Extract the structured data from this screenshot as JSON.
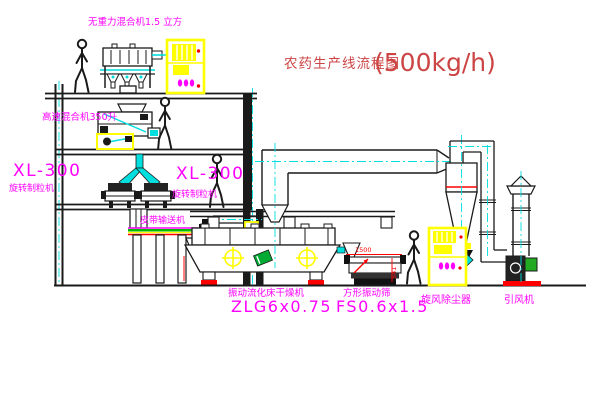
{
  "title": {
    "name": "农药生产线流程图",
    "capacity": "(500kg/h)"
  },
  "equipment_labels": {
    "gravity_mixer": "无重力混合机1.5 立方",
    "high_speed_mixer": "高速混合机350升",
    "granulator_left_model": "XL-300",
    "granulator_left_name": "旋转制粒机",
    "granulator_mid_model": "XL-300",
    "granulator_mid_name": "旋转制粒机",
    "belt_conveyor": "皮带输送机",
    "fluid_bed_dryer_name": "振动流化床干燥机",
    "fluid_bed_dryer_model": "ZLG6x0.75",
    "vibrating_screen_name": "方形振动筛",
    "vibrating_screen_model": "FS0.6x1.5",
    "cyclone_dust_collector": "旋风除尘器",
    "induced_draft_fan": "引风机"
  },
  "dimensions": {
    "screen_length": "1500",
    "screen_height": "541"
  },
  "colors": {
    "label_magenta": "#ff00ff",
    "title_red": "#cc4444",
    "line_black": "#1a1a1a",
    "centerline_cyan": "#00dede",
    "cabinet_yellow": "#ffff00",
    "alert_red": "#ff0000",
    "motor_green": "#22aa22"
  }
}
